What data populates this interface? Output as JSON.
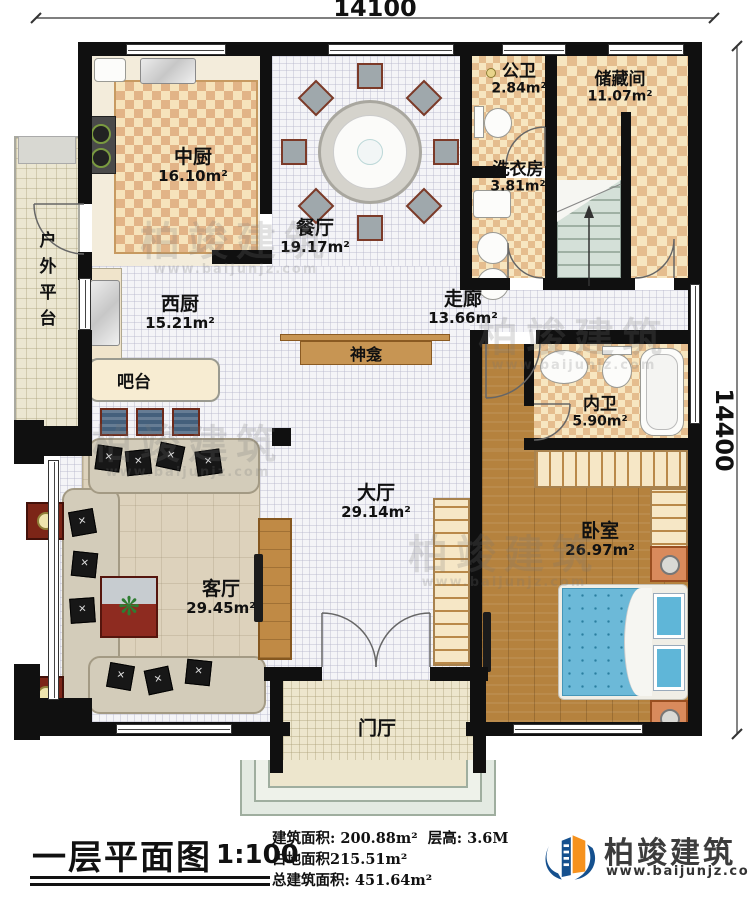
{
  "dimensions": {
    "top": "14100",
    "right": "14400"
  },
  "rooms": [
    {
      "name": "中厨",
      "area": "16.10m²"
    },
    {
      "name": "餐厅",
      "area": "19.17m²"
    },
    {
      "name": "公卫",
      "area": "2.84m²"
    },
    {
      "name": "储藏间",
      "area": "11.07m²"
    },
    {
      "name": "洗衣房",
      "area": "3.81m²"
    },
    {
      "name": "西厨",
      "area": "15.21m²"
    },
    {
      "name": "走廊",
      "area": "13.66m²"
    },
    {
      "name": "内卫",
      "area": "5.90m²"
    },
    {
      "name": "大厅",
      "area": "29.14m²"
    },
    {
      "name": "卧室",
      "area": "26.97m²"
    },
    {
      "name": "客厅",
      "area": "29.45m²"
    }
  ],
  "features": {
    "outdoor_platform": "户外平台",
    "bar": "吧台",
    "shrine": "神龛",
    "foyer": "门厅"
  },
  "title_block": {
    "title": "一层平面图",
    "scale": "1:100",
    "info1a": "建筑面积: 200.88m²",
    "info1b": "层高: 3.6M",
    "info2": "占地面积215.51m²",
    "info3": "总建筑面积: 451.64m²"
  },
  "logo": {
    "name": "柏竣建筑",
    "url": "www.baijunjz.com"
  },
  "watermark": {
    "text": "柏竣建筑",
    "url": "www.baijunjz.com"
  },
  "colors": {
    "wall": "#101010",
    "checker_dark": "#e5bd8e",
    "checker_light": "#f7e6c0",
    "wood_floor": "#b5823e",
    "bed_blue": "#6cb9d8",
    "logo_blue": "#15508e",
    "logo_orange": "#f6921e"
  }
}
